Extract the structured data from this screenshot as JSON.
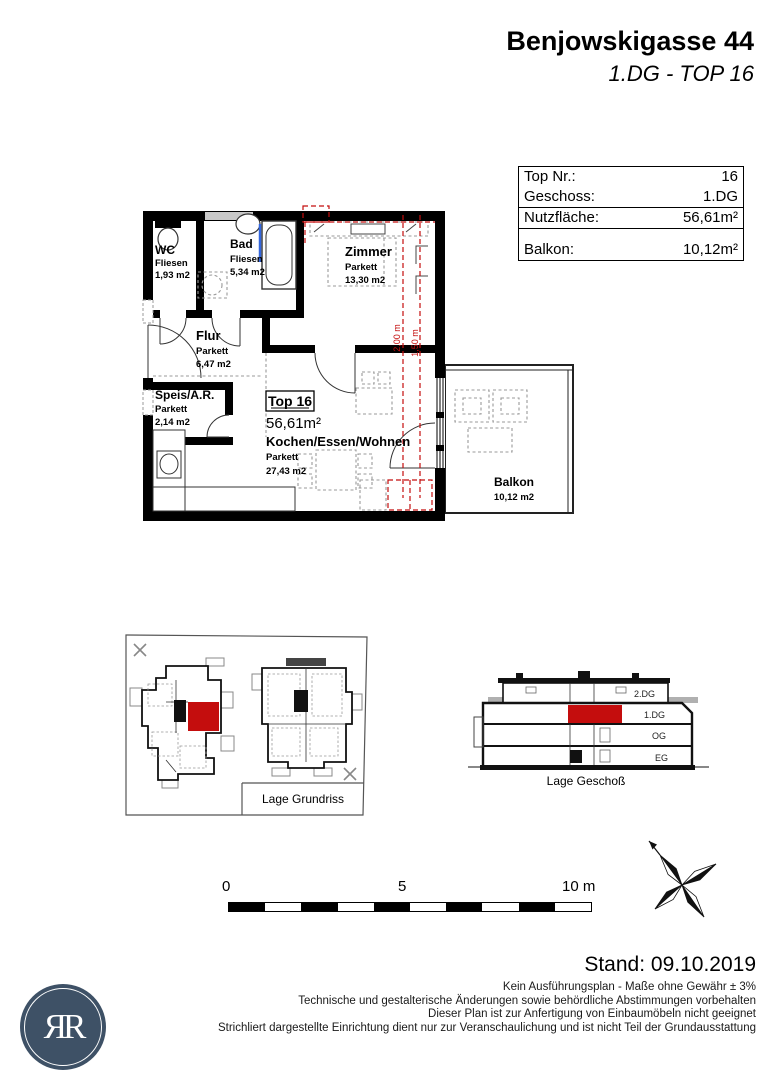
{
  "header": {
    "title": "Benjowskigasse 44",
    "subtitle": "1.DG - TOP 16"
  },
  "info_table": {
    "rows": [
      {
        "label": "Top Nr.:",
        "value": "16"
      },
      {
        "label": "Geschoss:",
        "value": "1.DG"
      },
      {
        "label": "Nutzfläche:",
        "value": "56,61m²"
      },
      {
        "label": "Balkon:",
        "value": "10,12m²"
      }
    ]
  },
  "floor_plan": {
    "unit_label": "Top 16",
    "unit_area": "56,61m²",
    "rooms": [
      {
        "name": "WC",
        "floor": "Fliesen",
        "area": "1,93 m2"
      },
      {
        "name": "Bad",
        "floor": "Fliesen",
        "area": "5,34 m2"
      },
      {
        "name": "Zimmer",
        "floor": "Parkett",
        "area": "13,30 m2"
      },
      {
        "name": "Flur",
        "floor": "Parkett",
        "area": "6,47 m2"
      },
      {
        "name": "Speis/A.R.",
        "floor": "Parkett",
        "area": "2,14 m2"
      },
      {
        "name": "Kochen/Essen/Wohnen",
        "floor": "Parkett",
        "area": "27,43 m2"
      },
      {
        "name": "Balkon",
        "area": "10,12 m2"
      }
    ],
    "dimensions": [
      "2,00 m",
      "1,50 m"
    ]
  },
  "site_plan": {
    "caption": "Lage Grundriss"
  },
  "section": {
    "caption": "Lage Geschoß",
    "levels": [
      "2.DG",
      "1.DG",
      "OG",
      "EG"
    ]
  },
  "scale_bar": {
    "start": "0",
    "mid": "5",
    "end": "10 m"
  },
  "footer": {
    "stand": "Stand: 09.10.2019",
    "disclaimers": [
      "Kein Ausführungsplan - Maße ohne Gewähr ± 3%",
      "Technische und gestalterische Änderungen sowie behördliche Abstimmungen vorbehalten",
      "Dieser Plan ist zur Anfertigung von Einbaumöbeln nicht geeignet",
      "Strichliert dargestellte Einrichtung dient nur zur Veranschaulichung und ist nicht Teil der Grundausstattung"
    ],
    "logo_text": "ЯR"
  },
  "colors": {
    "accent_red": "#c40d0d",
    "logo_blue": "#3e5166"
  }
}
